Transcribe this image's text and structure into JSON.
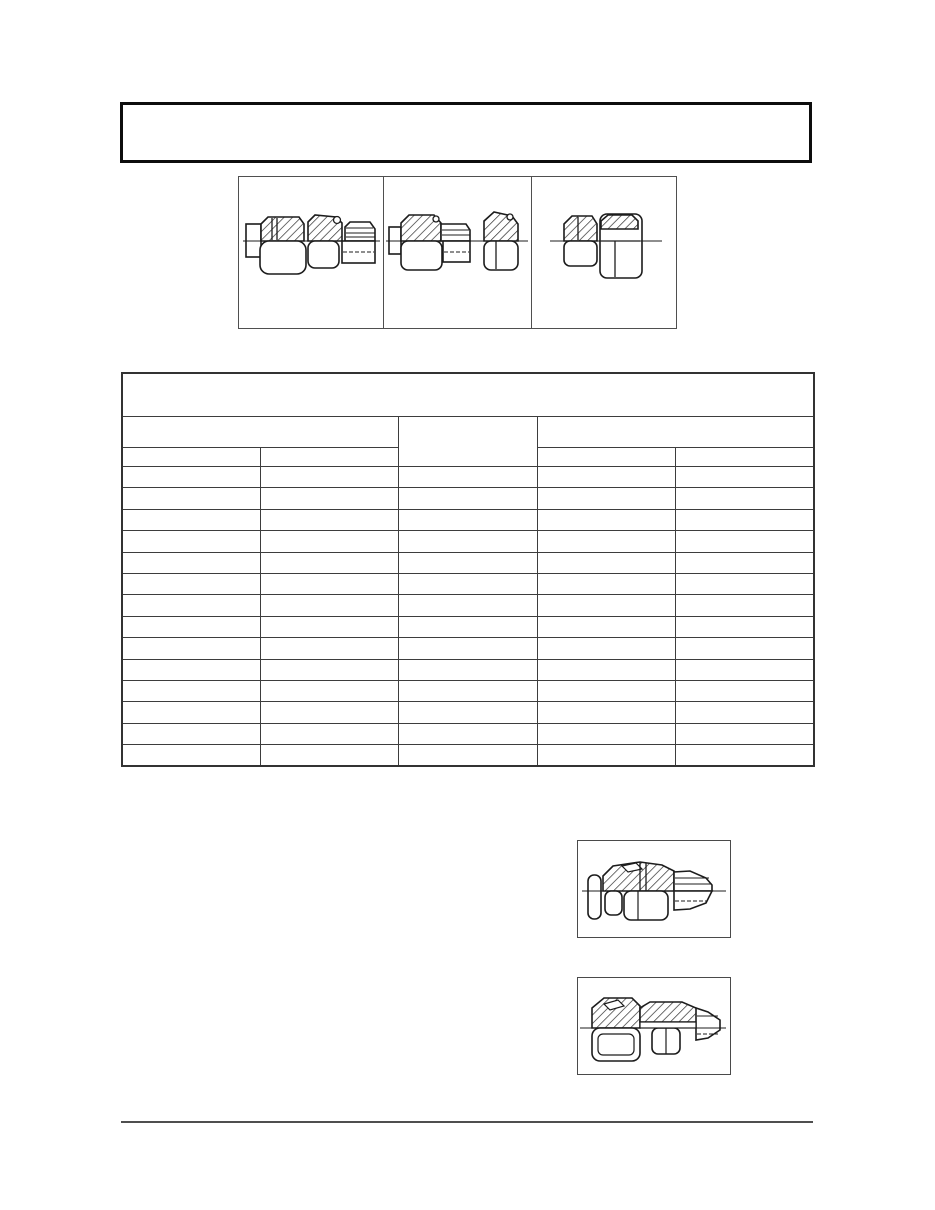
{
  "colors": {
    "background": "#ffffff",
    "heavy_border": "#0d0d0d",
    "table_line": "#3d3d3d",
    "thin_border": "#4f4f4f",
    "drawing_stroke": "#1c1c1c"
  },
  "title_box": {
    "text": ""
  },
  "figure_strip": {
    "figures": [
      {
        "name": "tube-union-long-fitting",
        "caption": ""
      },
      {
        "name": "fitting-body-and-separate-nut",
        "caption": ""
      },
      {
        "name": "compact-union-fitting",
        "caption": ""
      }
    ]
  },
  "spec_table": {
    "title": "",
    "left_group": {
      "label": "",
      "sub": [
        "",
        ""
      ]
    },
    "middle_column": {
      "label": ""
    },
    "right_group": {
      "label": "",
      "sub": [
        "",
        ""
      ]
    },
    "rows": [
      [
        "",
        "",
        "",
        "",
        ""
      ],
      [
        "",
        "",
        "",
        "",
        ""
      ],
      [
        "",
        "",
        "",
        "",
        ""
      ],
      [
        "",
        "",
        "",
        "",
        ""
      ],
      [
        "",
        "",
        "",
        "",
        ""
      ],
      [
        "",
        "",
        "",
        "",
        ""
      ],
      [
        "",
        "",
        "",
        "",
        ""
      ],
      [
        "",
        "",
        "",
        "",
        ""
      ],
      [
        "",
        "",
        "",
        "",
        ""
      ],
      [
        "",
        "",
        "",
        "",
        ""
      ],
      [
        "",
        "",
        "",
        "",
        ""
      ],
      [
        "",
        "",
        "",
        "",
        ""
      ],
      [
        "",
        "",
        "",
        "",
        ""
      ],
      [
        "",
        "",
        "",
        "",
        ""
      ]
    ]
  },
  "lower_figures": [
    {
      "name": "male-connector-fitting-a",
      "caption": ""
    },
    {
      "name": "male-connector-fitting-b",
      "caption": ""
    }
  ],
  "footer": {
    "rule_text": ""
  }
}
